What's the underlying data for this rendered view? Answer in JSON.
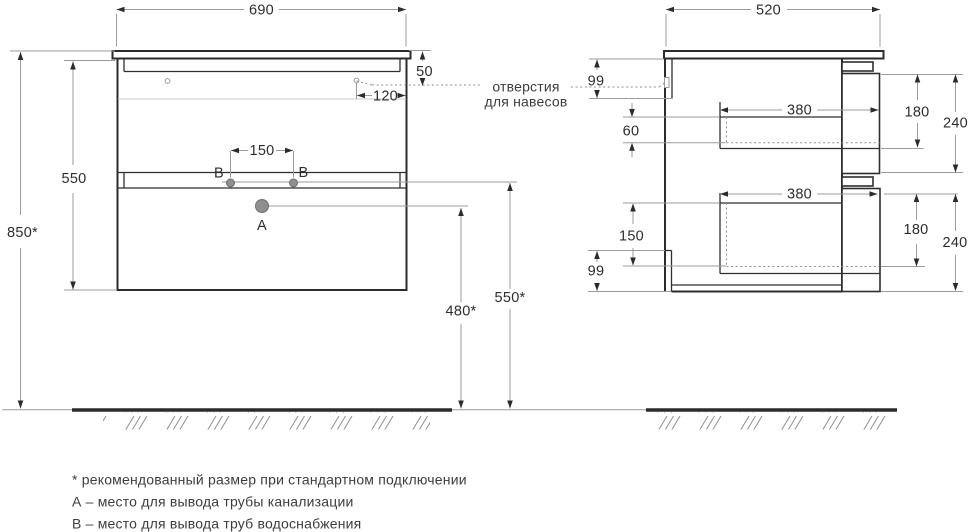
{
  "front": {
    "width": "690",
    "height_total": "850*",
    "height_body": "550",
    "hanger_top_offset": "50",
    "hanger_side_offset": "120",
    "water_spacing": "150",
    "drain_height": "480*",
    "water_height": "550*",
    "label_drain": "A",
    "label_water_left": "B",
    "label_water_right": "B"
  },
  "side": {
    "depth": "520",
    "rail_top": "99",
    "rail_bottom": "99",
    "drawer1": {
      "inset": "60",
      "depth": "380",
      "front": "180",
      "module": "240"
    },
    "drawer2": {
      "inset": "150",
      "depth": "380",
      "front": "180",
      "module": "240"
    }
  },
  "callout": {
    "line1": "отверстия",
    "line2": "для навесов"
  },
  "footnotes": [
    "* рекомендованный размер при стандартном подключении",
    "А – место для вывода трубы канализации",
    "В – место для вывода труб водоснабжения"
  ],
  "colors": {
    "line": "#2b2b2b",
    "thin_line": "#9b9b9b",
    "light_line": "#cccccc",
    "hole_fill": "#8f8f8f",
    "text": "#2d2d2d"
  }
}
